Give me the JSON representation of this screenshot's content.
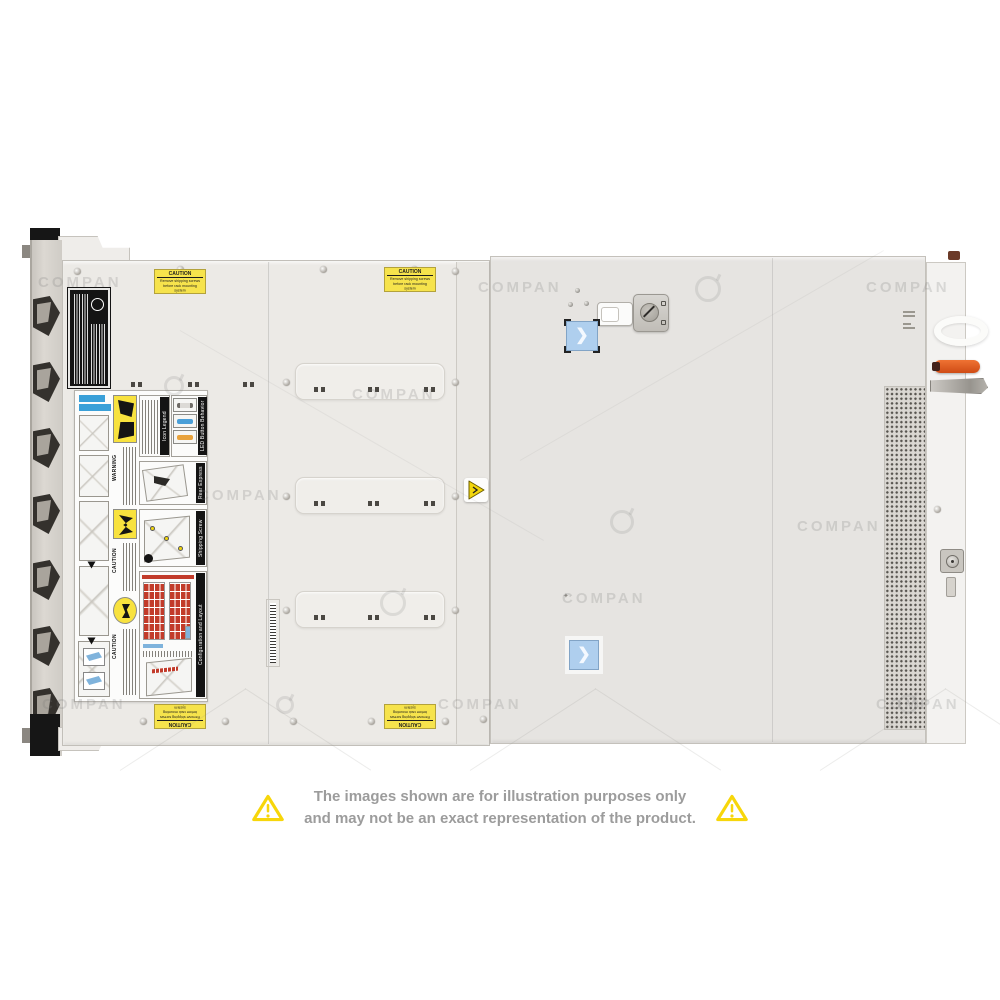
{
  "product": {
    "description": "Top view of a 2U rack server chassis with service labels",
    "orientation": "top-down"
  },
  "watermark": {
    "text": "COMPAN"
  },
  "caution_label": {
    "title": "CAUTION",
    "line1": "Remove shipping screws",
    "line2": "before rack mounting system"
  },
  "service_label": {
    "sections": [
      {
        "title": "Icon Legend"
      },
      {
        "title": "LED Button Behavior"
      },
      {
        "title": "Rear Express Service Tag"
      },
      {
        "title": "Shipping Screw Removal"
      },
      {
        "title": "Configuration and Layout"
      }
    ],
    "warning_text": "WARNING",
    "caution_text": "CAUTION"
  },
  "disclaimer": {
    "line1": "The images shown are for illustration purposes only",
    "line2": "and may not be an exact representation of the product."
  },
  "colors": {
    "caution_yellow": "#F6E34C",
    "warning_triangle_yellow": "#F7D60A",
    "disclaimer_text_gray": "#9C9C9C",
    "blue_latch_button": "#AFCFEE",
    "orange_release_lever": "#E05A1F",
    "chassis_left_cover": "#ECEAE6",
    "chassis_right_cover": "#E6E4E1",
    "regulatory_label_black": "#141414",
    "drive_map_red": "#C23B2A",
    "led_bar_blue": "#4A9FD8",
    "led_bar_orange": "#E8A23C",
    "service_tag_blue": "#3AA0D8"
  }
}
